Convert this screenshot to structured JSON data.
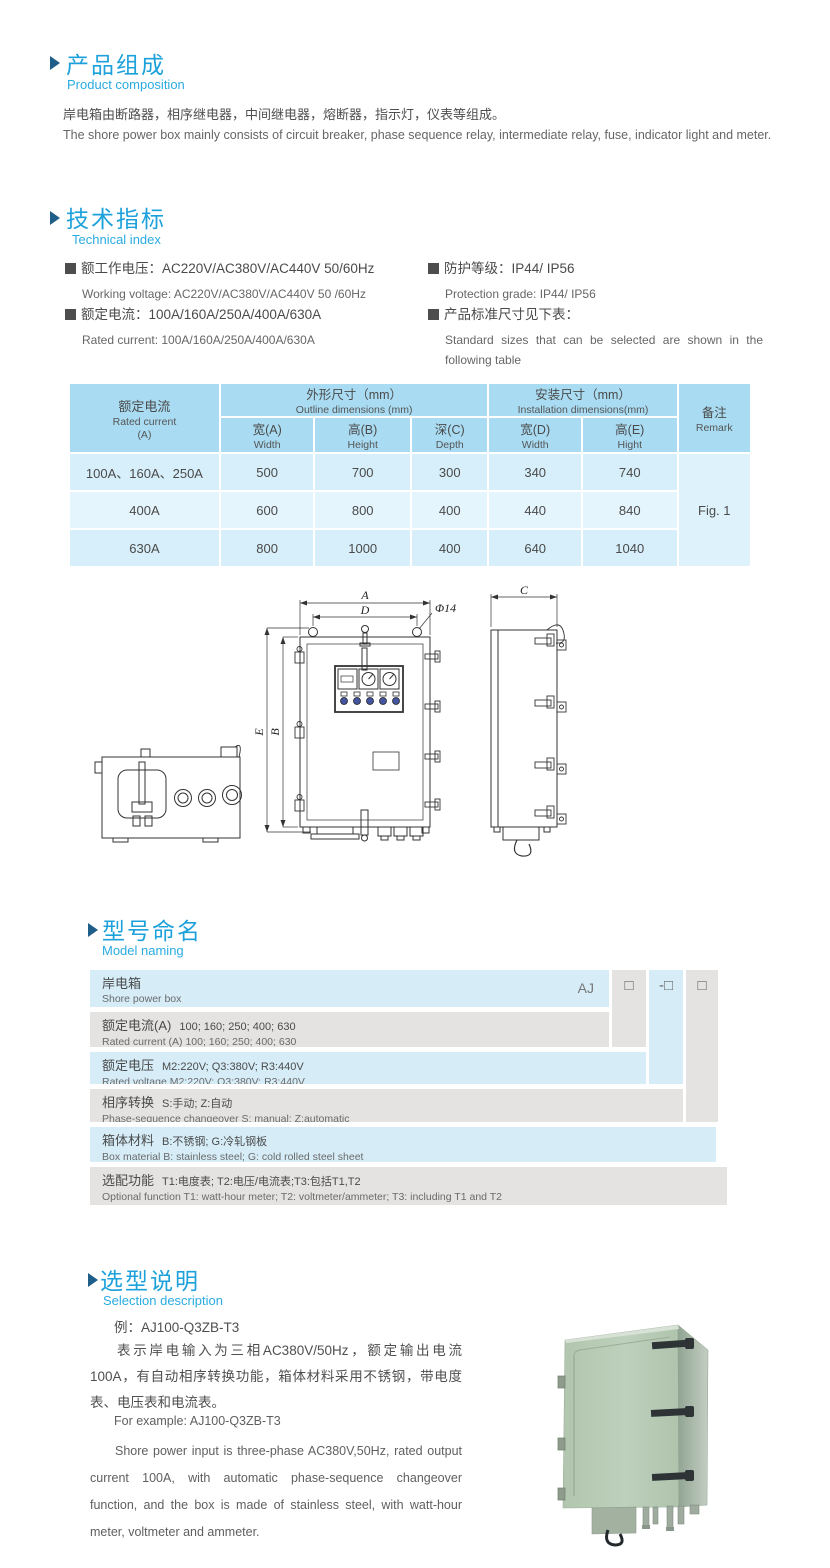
{
  "product_composition": {
    "title_cn": "产品组成",
    "title_en": "Product  composition",
    "body_cn": "岸电箱由断路器，相序继电器，中间继电器，熔断器，指示灯，仪表等组成。",
    "body_en": "The shore power box mainly consists of circuit breaker, phase sequence relay, intermediate relay, fuse, indicator light and meter."
  },
  "technical_index": {
    "title_cn": "技术指标",
    "title_en": "Technical index",
    "specs": [
      {
        "cn": "额工作电压：AC220V/AC380V/AC440V  50/60Hz",
        "en": "Working voltage: AC220V/AC380V/AC440V 50 /60Hz"
      },
      {
        "cn": "额定电流：100A/160A/250A/400A/630A",
        "en": "Rated current: 100A/160A/250A/400A/630A"
      },
      {
        "cn": "防护等级：IP44/ IP56",
        "en": "Protection grade: IP44/ IP56"
      },
      {
        "cn": "产品标准尺寸见下表：",
        "en": "Standard sizes that can be selected are shown in the following table"
      }
    ]
  },
  "size_table": {
    "rated_current_cn": "额定电流",
    "rated_current_en": "Rated current",
    "rated_current_unit": "(A)",
    "outline_cn": "外形尺寸（mm）",
    "outline_en": "Outline dimensions (mm)",
    "install_cn": "安装尺寸（mm）",
    "install_en": "Installation dimensions(mm)",
    "remark_cn": "备注",
    "remark_en": "Remark",
    "subheaders": [
      {
        "cn": "宽(A)",
        "en": "Width"
      },
      {
        "cn": "高(B)",
        "en": "Height"
      },
      {
        "cn": "深(C)",
        "en": "Depth"
      },
      {
        "cn": "宽(D)",
        "en": "Width"
      },
      {
        "cn": "高(E)",
        "en": "Hight"
      }
    ],
    "rows": [
      {
        "current": "100A、160A、250A",
        "values": [
          "500",
          "700",
          "300",
          "340",
          "740"
        ]
      },
      {
        "current": "400A",
        "values": [
          "600",
          "800",
          "400",
          "440",
          "840"
        ]
      },
      {
        "current": "630A",
        "values": [
          "800",
          "1000",
          "400",
          "640",
          "1040"
        ]
      }
    ],
    "remark_value": "Fig. 1"
  },
  "figure": {
    "dim_a": "A",
    "dim_b": "B",
    "dim_c": "C",
    "dim_d": "D",
    "dim_e": "E",
    "hole_label": "Φ14"
  },
  "model_naming": {
    "title_cn": "型号命名",
    "title_en": "Model naming",
    "prefix": "AJ",
    "code_boxes": [
      "□",
      "-□",
      "□"
    ],
    "rows": [
      {
        "cn": "岸电箱",
        "detail": "",
        "en": "Shore power box"
      },
      {
        "cn": "额定电流(A)",
        "detail": "100; 160; 250; 400; 630",
        "en": "Rated current (A) 100; 160; 250; 400; 630"
      },
      {
        "cn": "额定电压",
        "detail": "M2:220V;  Q3:380V;  R3:440V",
        "en": "Rated voltage  M2:220V;  Q3:380V;  R3:440V"
      },
      {
        "cn": "相序转换",
        "detail": "S:手动; Z:自动",
        "en": "Phase-sequence changeover  S: manual;  Z:automatic"
      },
      {
        "cn": "箱体材料",
        "detail": "B:不锈钢;  G:冷轧钢板",
        "en": "Box material   B: stainless steel; G: cold rolled steel sheet"
      },
      {
        "cn": "选配功能",
        "detail": "T1:电度表;  T2:电压/电流表;T3:包括T1,T2",
        "en": "Optional function   T1: watt-hour meter; T2: voltmeter/ammeter; T3: including T1 and T2"
      }
    ]
  },
  "selection": {
    "title_cn": "选型说明",
    "title_en": "Selection description",
    "example_cn": "例：AJ100-Q3ZB-T3",
    "body_cn": "表示岸电输入为三相AC380V/50Hz，额定输出电流100A，有自动相序转换功能，箱体材料采用不锈钢，带电度表、电压表和电流表。",
    "example_en": "For example: AJ100-Q3ZB-T3",
    "body_en": "Shore power input is three-phase AC380V,50Hz, rated output current 100A, with automatic phase-sequence changeover function, and the box is made of stainless steel, with watt-hour meter, voltmeter and ammeter."
  }
}
